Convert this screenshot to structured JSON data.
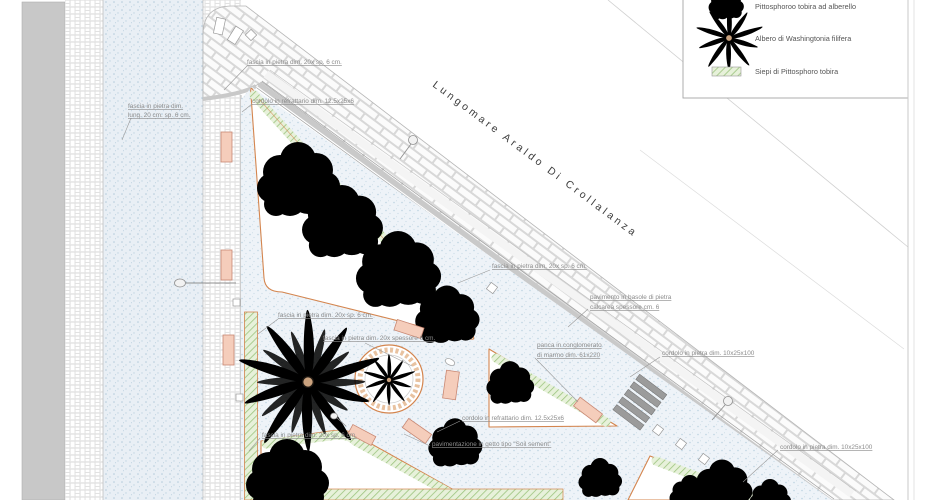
{
  "drawing": {
    "street_name": "Lungomare Araldo Di Crollalanza"
  },
  "legend": {
    "items": [
      {
        "icon": "tree-canopy-icon",
        "label": "Pittosphoroo tobira ad alberello"
      },
      {
        "icon": "palm-icon",
        "label": "Albero di Washingtonia filifera"
      },
      {
        "icon": "hedge-icon",
        "label": "Siepi di Pittosphoro tobira"
      }
    ]
  },
  "annotations": [
    {
      "text": "fascia in pietra dim. 20x sp. 6 cm."
    },
    {
      "lines": [
        "fascia in pietra dim.",
        "lung. 20 cm. sp. 6 cm."
      ]
    },
    {
      "text": "cordolo in refrattario dim. 12.5x25x6"
    },
    {
      "text": "fascia in pietra dim. 20x sp. 6 cm."
    },
    {
      "lines": [
        "pavimento in basole di pietra",
        "calcarea spessore cm. 6"
      ]
    },
    {
      "text": "fascia in pietra dim. 20x sp. 6 cm."
    },
    {
      "text": "fascia in pietra dim. 20x spessore 6 cm."
    },
    {
      "lines": [
        "panca in conglomerato",
        "di marmo dim. 61x220"
      ]
    },
    {
      "text": "cordolo in pietra dim. 10x25x100"
    },
    {
      "text": "cordolo in refrattario dim. 12.5x25x6"
    },
    {
      "text": "pavimentazione in getto tipo \"Soil sement\""
    },
    {
      "text": "fascia in pietra dim. 20x sp. 6 cm."
    },
    {
      "text": "cordolo in pietra dim. 10x25x100"
    }
  ],
  "colors": {
    "cordolo_orange": "#d4854e",
    "hedge_green": "#9cc47e",
    "tree_green": "#c6e7b0",
    "tree_orange": "#e0802a",
    "palm_olive": "#8ca73f",
    "bench_pink": "#f5cdbb",
    "paving_blue_dot": "#b9cfdd",
    "curb_gray": "#c9c9c9"
  }
}
